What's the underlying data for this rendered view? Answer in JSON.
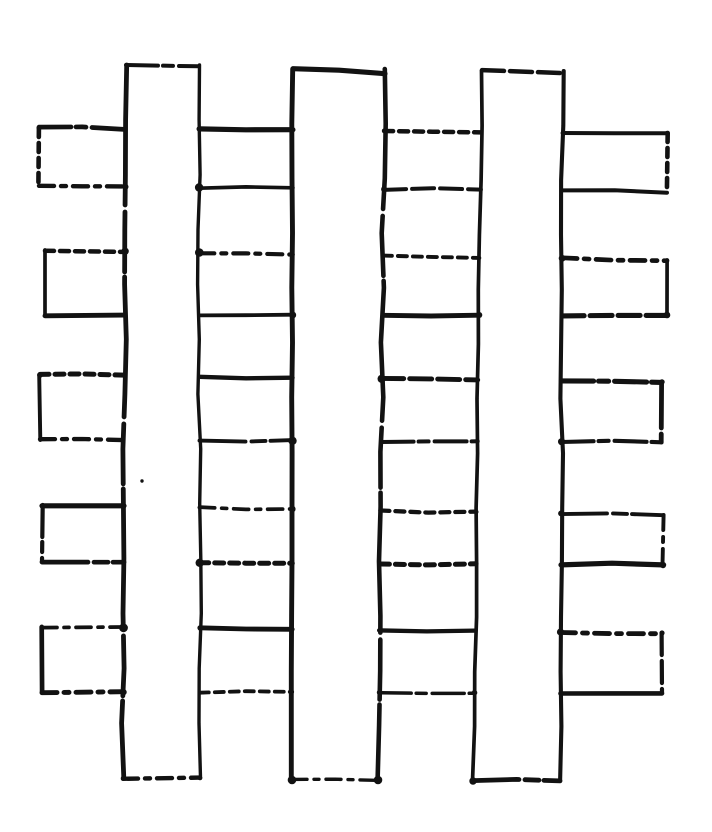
{
  "figure": {
    "description": "Hand-drawn ink sketch of a lattice: three vertical strips crossing five horizontal strips, with every vertical strip drawn passing in front of the horizontal strips; lines are sketchy and intermittently dashed, black ink on white paper",
    "canvas": {
      "width": 712,
      "height": 832,
      "background": "#ffffff",
      "ink": "#121212"
    },
    "layering": "vertical_over_horizontal",
    "vertical_strips": [
      {
        "id": "v1",
        "x_left_top": 126,
        "x_left_bottom": 123,
        "x_right_top": 199,
        "x_right_bottom": 200,
        "y_top": 65,
        "y_bottom": 778,
        "top_cap_drop": 1
      },
      {
        "id": "v2",
        "x_left_top": 293,
        "x_left_bottom": 292,
        "x_right_top": 385,
        "x_right_bottom": 378,
        "y_top": 69,
        "y_bottom": 780,
        "top_cap_drop": 5
      },
      {
        "id": "v3",
        "x_left_top": 482,
        "x_left_bottom": 473,
        "x_right_top": 563,
        "x_right_bottom": 560,
        "y_top": 71,
        "y_bottom": 781,
        "top_cap_drop": 3
      }
    ],
    "horizontal_strips": [
      {
        "id": "h1",
        "x_left": 39,
        "x_right": 667,
        "y_top_left": 128,
        "y_top_right": 133,
        "y_bottom_left": 186,
        "y_bottom_right": 192
      },
      {
        "id": "h2",
        "x_left": 45,
        "x_right": 667,
        "y_top_left": 250,
        "y_top_right": 260,
        "y_bottom_left": 315,
        "y_bottom_right": 315
      },
      {
        "id": "h3",
        "x_left": 40,
        "x_right": 662,
        "y_top_left": 375,
        "y_top_right": 382,
        "y_bottom_left": 440,
        "y_bottom_right": 442
      },
      {
        "id": "h4",
        "x_left": 42,
        "x_right": 663,
        "y_top_left": 505,
        "y_top_right": 515,
        "y_bottom_left": 562,
        "y_bottom_right": 565
      },
      {
        "id": "h5",
        "x_left": 42,
        "x_right": 662,
        "y_top_left": 627,
        "y_top_right": 633,
        "y_bottom_left": 692,
        "y_bottom_right": 693
      }
    ],
    "ink_speck": {
      "x": 142,
      "y": 481
    }
  }
}
